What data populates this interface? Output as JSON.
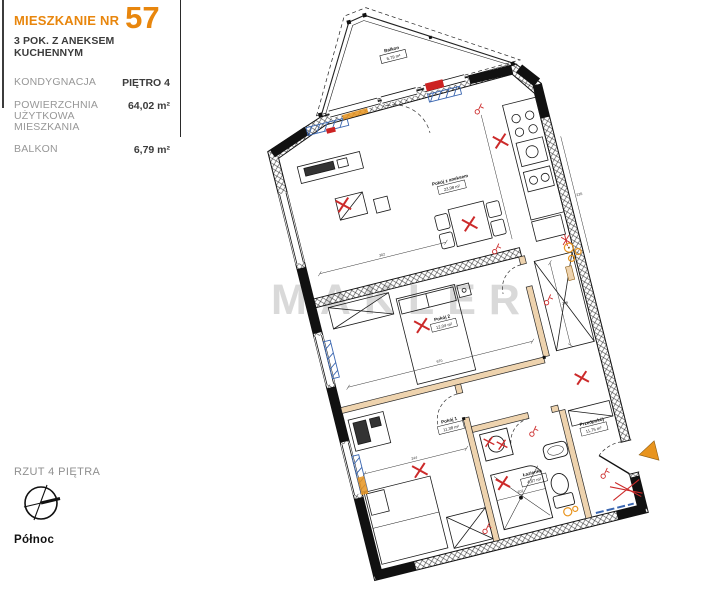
{
  "header": {
    "apartment_label": "MIESZKANIE NR",
    "apartment_number": "57",
    "subtitle": "3 POK. Z ANEKSEM KUCHENNYM"
  },
  "details": {
    "rows": [
      {
        "label": "KONDYGNACJA",
        "value": "PIĘTRO 4"
      },
      {
        "label": "POWIERZCHNIA UŻYTKOWA MIESZKANIA",
        "value": "64,02 m²"
      },
      {
        "label": "BALKON",
        "value": "6,79 m²"
      }
    ]
  },
  "footer": {
    "plan_view_label": "RZUT 4 PIĘTRA",
    "compass_label": "Północ"
  },
  "watermark": "MAKLER",
  "floor_plan": {
    "rotation_deg": -14,
    "rooms": [
      {
        "name": "Balkon",
        "area": "6,79 m²"
      },
      {
        "name": "Pokój z aneksem",
        "area": "23,98 m²"
      },
      {
        "name": "Pokój 2",
        "area": "12,04 m²"
      },
      {
        "name": "Pokój 1",
        "area": "11,38 m²"
      },
      {
        "name": "Łazienka",
        "area": "4,87 m²"
      },
      {
        "name": "Przedpokój",
        "area": "11,75 m²"
      }
    ],
    "dimensions": [
      "302",
      "670",
      "244",
      "202",
      "206",
      "235"
    ],
    "colors": {
      "accent_orange": "#e8860d",
      "partition_tan": "#eed3ae",
      "electrical_red": "#cc2a2a",
      "radiator_blue": "#3a66b0",
      "watermark_gray": "#d9d9d9"
    }
  }
}
